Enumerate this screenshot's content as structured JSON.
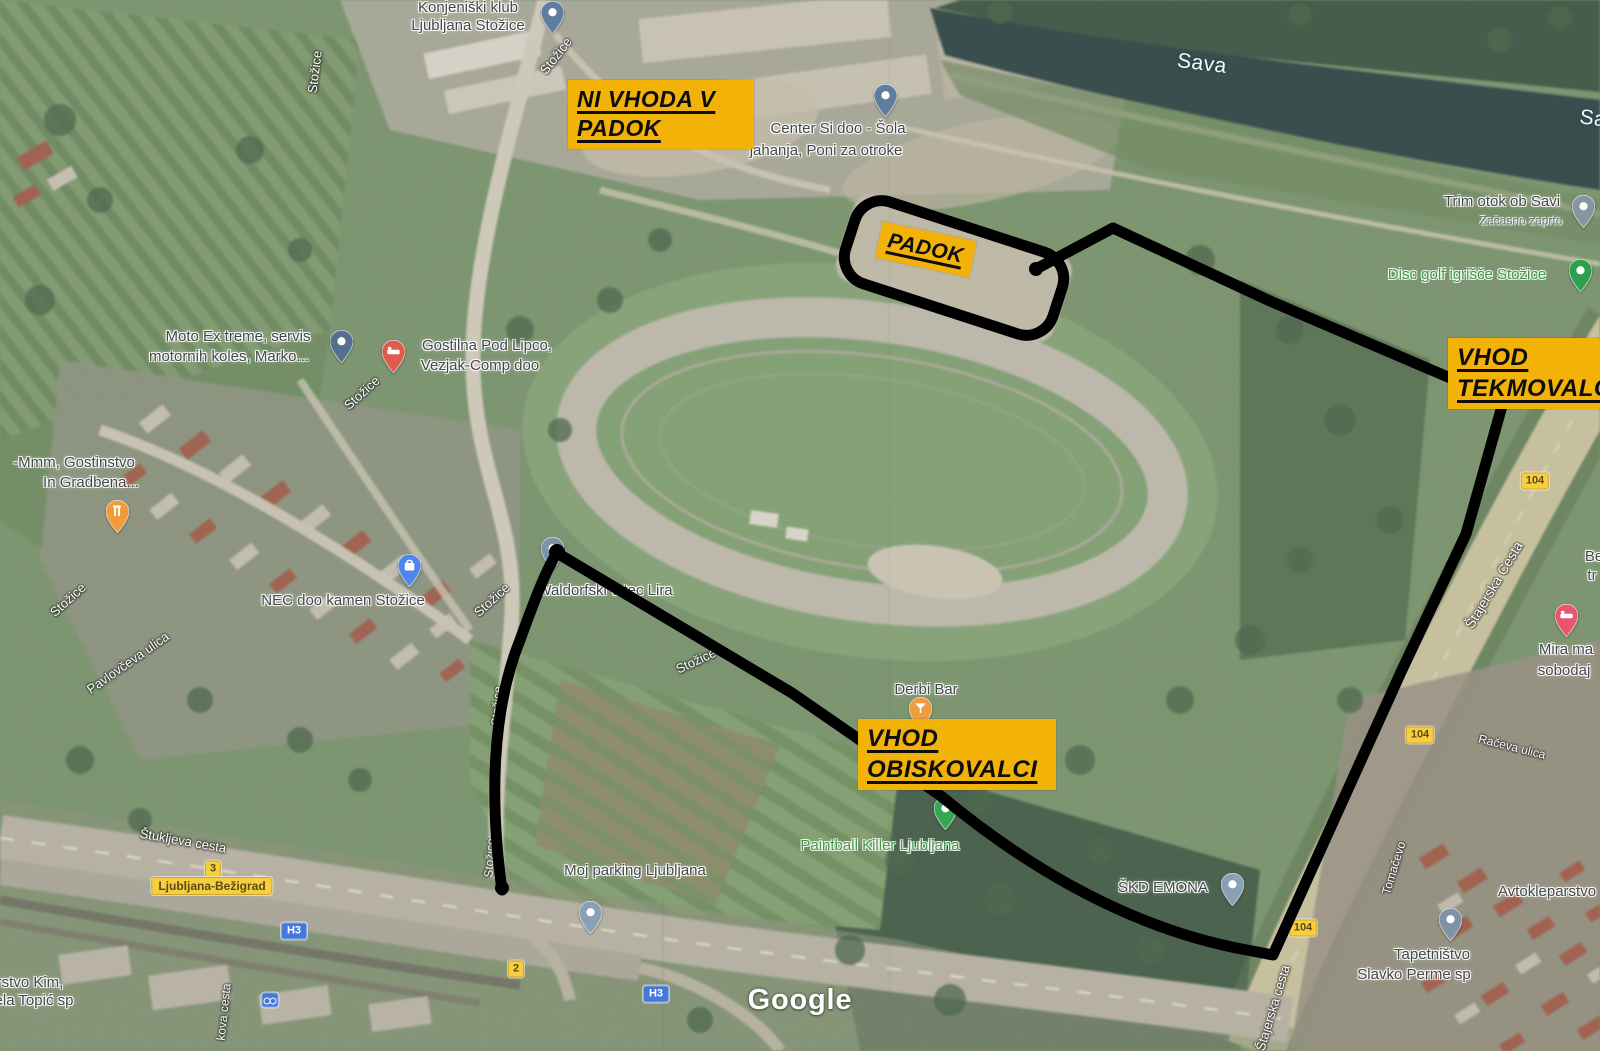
{
  "annotations": {
    "colors": {
      "box_bg": "#F3B208",
      "box_text": "#0d0d0d",
      "route": "#000000"
    },
    "boxes": [
      {
        "id": "no-entry-paddock",
        "lines": [
          "NI VHODA V",
          "PADOK"
        ],
        "x": 568,
        "y": 80,
        "w": 168,
        "fs": 23,
        "r": 0
      },
      {
        "id": "paddock",
        "lines": [
          "PADOK"
        ],
        "x": 878,
        "y": 231,
        "w": 78,
        "fs": 21,
        "r": 12
      },
      {
        "id": "entrance-competitors",
        "lines": [
          "VHOD",
          "TEKMOVALCI"
        ],
        "x": 1448,
        "y": 338,
        "w": 160,
        "fs": 24,
        "r": 0
      },
      {
        "id": "entrance-visitors",
        "lines": [
          "VHOD",
          "OBISKOVALCI"
        ],
        "x": 858,
        "y": 719,
        "w": 180,
        "fs": 24,
        "r": 0
      }
    ]
  },
  "routes": {
    "visitor_d": "M502,890 C490,804 491,712 520,640 C536,596 547,568 557,553 L792,693 L941,796 C1040,878 1143,931 1247,950 L1273,955 L1334,820 L1401,672 L1466,534 L1502,406",
    "competitor_d": "M1036,269 L1113,228 L1270,301 L1455,380 L1500,405",
    "paddock_rect": {
      "cx": 954,
      "cy": 268,
      "w": 218,
      "h": 86,
      "rx": 28,
      "rot": 18
    },
    "stroke_width": 11,
    "caps": [
      {
        "x": 557,
        "y": 552,
        "r": 8
      },
      {
        "x": 502,
        "y": 888,
        "r": 7
      },
      {
        "x": 1036,
        "y": 269,
        "r": 7
      }
    ]
  },
  "watermark": {
    "text": "Google"
  },
  "map_labels": [
    {
      "t": "Konjeniški klub",
      "x": 468,
      "y": 8,
      "s": 15,
      "c": "poi"
    },
    {
      "t": "Ljubljana Stožice",
      "x": 468,
      "y": 26,
      "s": 15,
      "c": "poi"
    },
    {
      "t": "Center Si doo - Šola",
      "x": 838,
      "y": 129,
      "s": 15,
      "c": "poi"
    },
    {
      "t": "jahanja, Poni za otroke",
      "x": 826,
      "y": 151,
      "s": 15,
      "c": "poi"
    },
    {
      "t": "Sava",
      "x": 1202,
      "y": 64,
      "s": 21,
      "c": "water",
      "r": 7
    },
    {
      "t": "Sa",
      "x": 1593,
      "y": 119,
      "s": 21,
      "c": "water",
      "r": 7
    },
    {
      "t": "Trim otok ob Savi",
      "x": 1502,
      "y": 202,
      "s": 15,
      "c": "poi"
    },
    {
      "t": "Začasno zaprto",
      "x": 1521,
      "y": 221,
      "s": 12,
      "c": "sub"
    },
    {
      "t": "Disc golf igrišče Stožice",
      "x": 1467,
      "y": 275,
      "s": 15,
      "c": "green"
    },
    {
      "t": "Stožice",
      "x": 315,
      "y": 72,
      "s": 13,
      "c": "road",
      "r": -83
    },
    {
      "t": "Stožice",
      "x": 556,
      "y": 56,
      "s": 13,
      "c": "road",
      "r": -52
    },
    {
      "t": "Moto Ex treme, servis",
      "x": 238,
      "y": 337,
      "s": 15,
      "c": "poi"
    },
    {
      "t": "motornih koles, Marko...",
      "x": 229,
      "y": 357,
      "s": 15,
      "c": "poi"
    },
    {
      "t": "Gostilna Pod Lipco,",
      "x": 487,
      "y": 346,
      "s": 15,
      "c": "poi"
    },
    {
      "t": "Vezjak-Comp doo",
      "x": 480,
      "y": 366,
      "s": 15,
      "c": "poi"
    },
    {
      "t": "Stožice",
      "x": 362,
      "y": 393,
      "s": 13,
      "c": "road",
      "r": -42
    },
    {
      "t": "-Mmm, Gostinstvo",
      "x": 74,
      "y": 463,
      "s": 15,
      "c": "poi"
    },
    {
      "t": "In Gradbena...",
      "x": 91,
      "y": 483,
      "s": 15,
      "c": "poi"
    },
    {
      "t": "Stožice",
      "x": 68,
      "y": 600,
      "s": 13,
      "c": "road",
      "r": -42
    },
    {
      "t": "Pavlovčeva ulica",
      "x": 128,
      "y": 663,
      "s": 13,
      "c": "road",
      "r": -35
    },
    {
      "t": "NEC doo kamen Stožice",
      "x": 343,
      "y": 601,
      "s": 15,
      "c": "poi"
    },
    {
      "t": "Stožice",
      "x": 492,
      "y": 600,
      "s": 13,
      "c": "road",
      "r": -42
    },
    {
      "t": "Waldorfski vrtec Lira",
      "x": 605,
      "y": 591,
      "s": 15,
      "c": "poi"
    },
    {
      "t": "Stožice",
      "x": 696,
      "y": 661,
      "s": 13,
      "c": "road",
      "r": -25
    },
    {
      "t": "Stožice",
      "x": 497,
      "y": 706,
      "s": 12,
      "c": "road",
      "r": -86
    },
    {
      "t": "Stožice",
      "x": 490,
      "y": 858,
      "s": 12,
      "c": "road",
      "r": -86
    },
    {
      "t": "Derbi Bar",
      "x": 926,
      "y": 690,
      "s": 15,
      "c": "poi"
    },
    {
      "t": "Paintball Killer Ljubljana",
      "x": 880,
      "y": 846,
      "s": 15,
      "c": "green"
    },
    {
      "t": "ŠKD EMONA",
      "x": 1163,
      "y": 888,
      "s": 15,
      "c": "poi"
    },
    {
      "t": "Moj parking Ljubljana",
      "x": 635,
      "y": 871,
      "s": 15,
      "c": "poi"
    },
    {
      "t": "Štukljeva cesta",
      "x": 183,
      "y": 841,
      "s": 13,
      "c": "road",
      "r": 10
    },
    {
      "t": "kova cesta",
      "x": 224,
      "y": 1012,
      "s": 12,
      "c": "road",
      "r": -84
    },
    {
      "t": "rstvo Kim,",
      "x": 30,
      "y": 983,
      "s": 15,
      "c": "poi"
    },
    {
      "t": "ela Topić sp",
      "x": 34,
      "y": 1001,
      "s": 15,
      "c": "poi"
    },
    {
      "t": "Štajerska Cesta",
      "x": 1494,
      "y": 585,
      "s": 14,
      "c": "road",
      "r": -59
    },
    {
      "t": "Štajerska cesta",
      "x": 1273,
      "y": 1008,
      "s": 13,
      "c": "road",
      "r": -73
    },
    {
      "t": "Tomačevo",
      "x": 1394,
      "y": 868,
      "s": 12,
      "c": "road",
      "r": -73
    },
    {
      "t": "Račeva ulica",
      "x": 1512,
      "y": 747,
      "s": 12,
      "c": "road",
      "r": 14
    },
    {
      "t": "Tapetništvo",
      "x": 1432,
      "y": 955,
      "s": 15,
      "c": "poi"
    },
    {
      "t": "Slavko Perme sp",
      "x": 1414,
      "y": 975,
      "s": 15,
      "c": "poi"
    },
    {
      "t": "Avtokleparstvo",
      "x": 1547,
      "y": 892,
      "s": 15,
      "c": "poi"
    },
    {
      "t": "Mira ma",
      "x": 1566,
      "y": 650,
      "s": 15,
      "c": "poi"
    },
    {
      "t": "sobodaj",
      "x": 1564,
      "y": 671,
      "s": 15,
      "c": "poi"
    },
    {
      "t": "Be",
      "x": 1594,
      "y": 557,
      "s": 15,
      "c": "poi"
    },
    {
      "t": "tr",
      "x": 1592,
      "y": 576,
      "s": 15,
      "c": "poi"
    }
  ],
  "badges": [
    {
      "t": "3",
      "x": 213,
      "y": 869,
      "k": "yellow"
    },
    {
      "t": "Ljubljana-Bežigrad",
      "x": 212,
      "y": 886,
      "k": "yellow big"
    },
    {
      "t": "H3",
      "x": 294,
      "y": 931,
      "k": "blue"
    },
    {
      "t": "H3",
      "x": 656,
      "y": 994,
      "k": "blue"
    },
    {
      "t": "2",
      "x": 516,
      "y": 969,
      "k": "yellow"
    },
    {
      "t": "104",
      "x": 1535,
      "y": 481,
      "k": "yellow"
    },
    {
      "t": "104",
      "x": 1420,
      "y": 735,
      "k": "yellow"
    },
    {
      "t": "104",
      "x": 1303,
      "y": 928,
      "k": "yellow"
    },
    {
      "t": "",
      "x": 270,
      "y": 1000,
      "k": "bike"
    }
  ],
  "pins": [
    {
      "x": 552,
      "y": 34,
      "c": "#5f7d9e",
      "g": "dot",
      "n": "konjeniski-klub"
    },
    {
      "x": 885,
      "y": 117,
      "c": "#5f7d9e",
      "g": "dot",
      "n": "center-si-doo"
    },
    {
      "x": 1583,
      "y": 228,
      "c": "#8795a1",
      "g": "dot",
      "n": "trim-otok"
    },
    {
      "x": 1580,
      "y": 292,
      "c": "#2e9e4f",
      "g": "dot",
      "n": "disc-golf"
    },
    {
      "x": 341,
      "y": 363,
      "c": "#54708c",
      "g": "dot",
      "n": "moto-ex-treme"
    },
    {
      "x": 393,
      "y": 373,
      "c": "#e05a4e",
      "g": "bed",
      "n": "gostilna-pod-lipco"
    },
    {
      "x": 117,
      "y": 533,
      "c": "#f29b38",
      "g": "fork",
      "n": "gostinstvo"
    },
    {
      "x": 409,
      "y": 587,
      "c": "#4f86ec",
      "g": "bag",
      "n": "nec-doo-kamen"
    },
    {
      "x": 552,
      "y": 570,
      "c": "#7e93a6",
      "g": "dot",
      "n": "waldorfski-vrtec"
    },
    {
      "x": 920,
      "y": 730,
      "c": "#ef9d3c",
      "g": "drink",
      "n": "derbi-bar"
    },
    {
      "x": 945,
      "y": 830,
      "c": "#34a853",
      "g": "dot",
      "n": "paintball-killer"
    },
    {
      "x": 1232,
      "y": 906,
      "c": "#8aa0b5",
      "g": "dot",
      "n": "skd-emona"
    },
    {
      "x": 590,
      "y": 934,
      "c": "#8aa0b5",
      "g": "dot",
      "n": "moj-parking"
    },
    {
      "x": 1566,
      "y": 637,
      "c": "#e8566d",
      "g": "bed",
      "n": "mira-sobodajalstvo"
    },
    {
      "x": 1450,
      "y": 941,
      "c": "#7e93a6",
      "g": "dot",
      "n": "tapetnistvo"
    }
  ]
}
